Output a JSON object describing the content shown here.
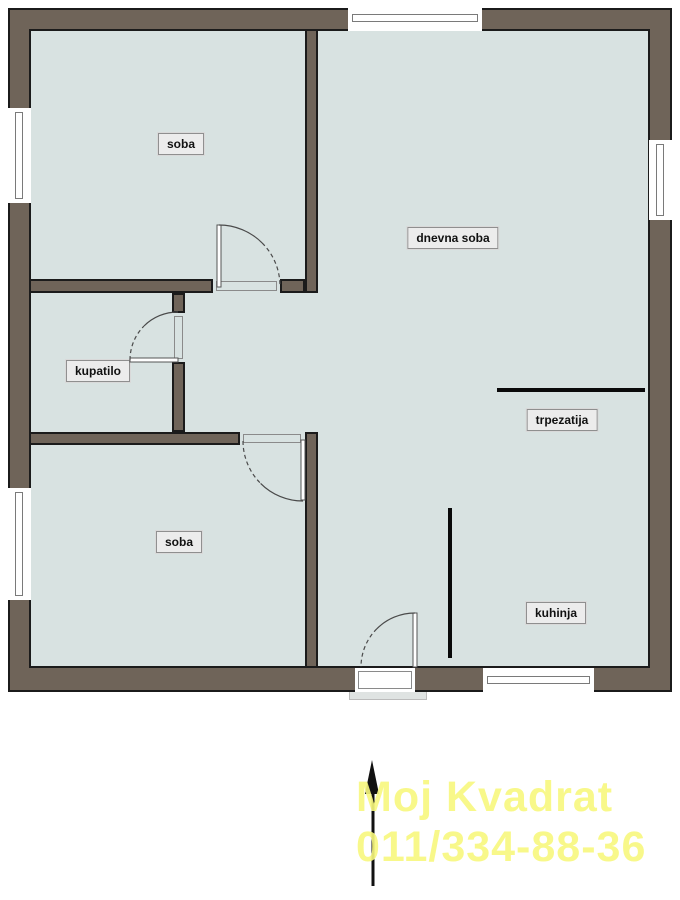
{
  "plan": {
    "rooms": [
      {
        "id": "soba-top",
        "label": "soba"
      },
      {
        "id": "dnevna-soba",
        "label": "dnevna soba"
      },
      {
        "id": "kupatilo",
        "label": "kupatilo"
      },
      {
        "id": "soba-bottom",
        "label": "soba"
      },
      {
        "id": "trpezatija",
        "label": "trpezatija"
      },
      {
        "id": "kuhinja",
        "label": "kuhinja"
      }
    ],
    "colors": {
      "wall": "#6F6459",
      "floor": "#D8E2E1",
      "outline": "#1b1b1b",
      "label_bg": "#ECECEC",
      "watermark": "#F8F87E"
    },
    "icons": [
      "north-arrow"
    ]
  },
  "watermark": {
    "line1": "Moj Kvadrat",
    "line2": "011/334-88-36"
  }
}
